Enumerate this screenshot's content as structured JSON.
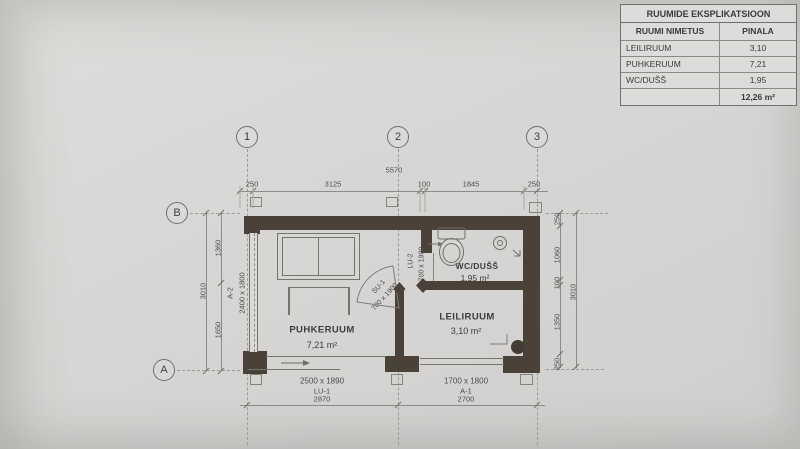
{
  "schedule": {
    "title": "RUUMIDE EKSPLIKATSIOON",
    "header": {
      "name": "RUUMI NIMETUS",
      "area": "PINALA"
    },
    "rows": [
      {
        "name": "LEILIRUUM",
        "area": "3,10"
      },
      {
        "name": "PUHKERUUM",
        "area": "7,21"
      },
      {
        "name": "WC/DUŠŠ",
        "area": "1,95"
      }
    ],
    "total": "12,26 m²"
  },
  "grid": {
    "columns": [
      "1",
      "2",
      "3"
    ],
    "rows": [
      "B",
      "A"
    ]
  },
  "dimensions": {
    "top": {
      "overall": "5570",
      "segments": [
        "250",
        "3125",
        "100",
        "1845",
        "250"
      ]
    },
    "left": {
      "overall": "3010",
      "segments": [
        "1360",
        "1650"
      ]
    },
    "right": {
      "overall": "3010",
      "segments": [
        "250",
        "1060",
        "100",
        "1350",
        "250"
      ]
    },
    "bottom": [
      {
        "size": "2500 x 1890",
        "code": "LU-1",
        "span": "2870"
      },
      {
        "size": "1700 x 1800",
        "code": "A-1",
        "span": "2700"
      }
    ]
  },
  "rooms": [
    {
      "name": "PUHKERUUM",
      "area": "7,21 m²"
    },
    {
      "name": "LEILIRUUM",
      "area": "3,10 m²"
    },
    {
      "name": "WC/DUŠŠ",
      "area": "1,95 m²"
    }
  ],
  "openings": {
    "window_left": {
      "code": "A-2",
      "size": "2400 x 1800"
    },
    "door_wc": {
      "code": "LU-2",
      "size": "700 x 1900"
    },
    "door_sauna": {
      "code": "SU-1",
      "size": "700 x 1900"
    }
  }
}
